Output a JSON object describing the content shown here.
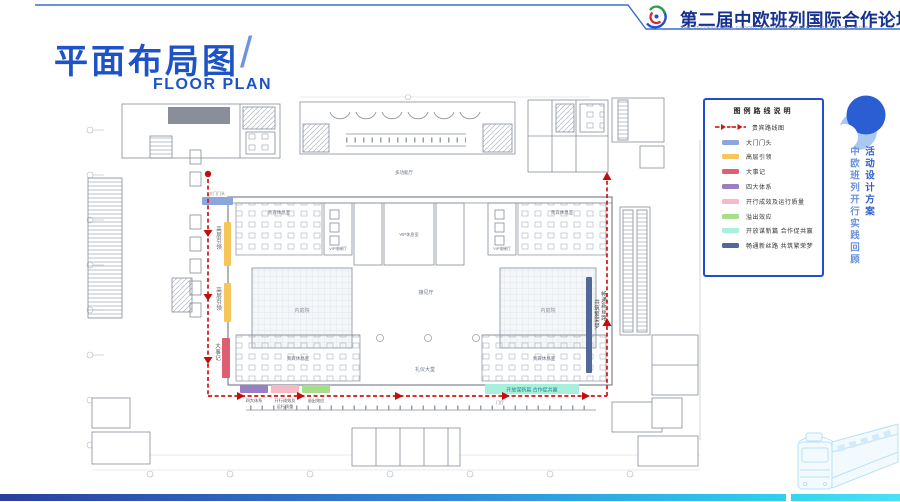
{
  "header": {
    "title": "第二届中欧班列国际合作论坛",
    "subtitle": "THE SECOND CHINA-EUROPE RAILWAY EXPRESS COOPERATION FORUM"
  },
  "page_title": {
    "zh": "平面布局图",
    "slash": "/",
    "en": "FLOOR PLAN"
  },
  "legend": {
    "title": "图例路线说明",
    "route_label": "贵宾路线图",
    "items": [
      {
        "label": "大门门头",
        "color": "#8CA5DC"
      },
      {
        "label": "高层引领",
        "color": "#F6C65A"
      },
      {
        "label": "大事记",
        "color": "#DC6070"
      },
      {
        "label": "四大体系",
        "color": "#9A7EC6"
      },
      {
        "label": "开行成效及运行质量",
        "color": "#F4BAC6"
      },
      {
        "label": "溢出效应",
        "color": "#A6DE8B"
      },
      {
        "label": "开放谋新篇 合作促共赢",
        "color": "#A9EFDE"
      },
      {
        "label": "畅通新丝路 共筑繁荣梦",
        "color": "#52689B"
      }
    ]
  },
  "floor_plan": {
    "labels": {
      "reception_hall": "接见厅",
      "ceremony_hall": "礼仪大堂",
      "courtyard": "内庭院",
      "vip_lounge": "贵宾休息室",
      "vip_room": "VIP休息室",
      "vip_elevator": "VIP电梯厅",
      "multi_hall": "多功能厅",
      "foyer": "门厅"
    },
    "zones": {
      "gate": "大门门头",
      "leadership": "高层引领",
      "milestones": "大事记",
      "four_systems": "四大体系",
      "performance_1": "开行成效及",
      "performance_2": "运行质量",
      "spillover": "溢出效应",
      "cyan_slogan": "开放谋新篇 合作促共赢",
      "blue_slogan_a": "畅通新丝路",
      "blue_slogan_b": "共筑繁荣梦"
    }
  },
  "side_panel": {
    "inner_column": "中欧班列开行实践回顾",
    "outer_column": "活动设计方案"
  },
  "colors": {
    "accent_blue": "#1d53c6",
    "header_blue": "#16328e",
    "route_red": "#d01515",
    "legend_border": "#1f4fd0",
    "bar_bottom_left": "#2a3f9e",
    "bar_bottom_right": "#2fd0ee"
  }
}
